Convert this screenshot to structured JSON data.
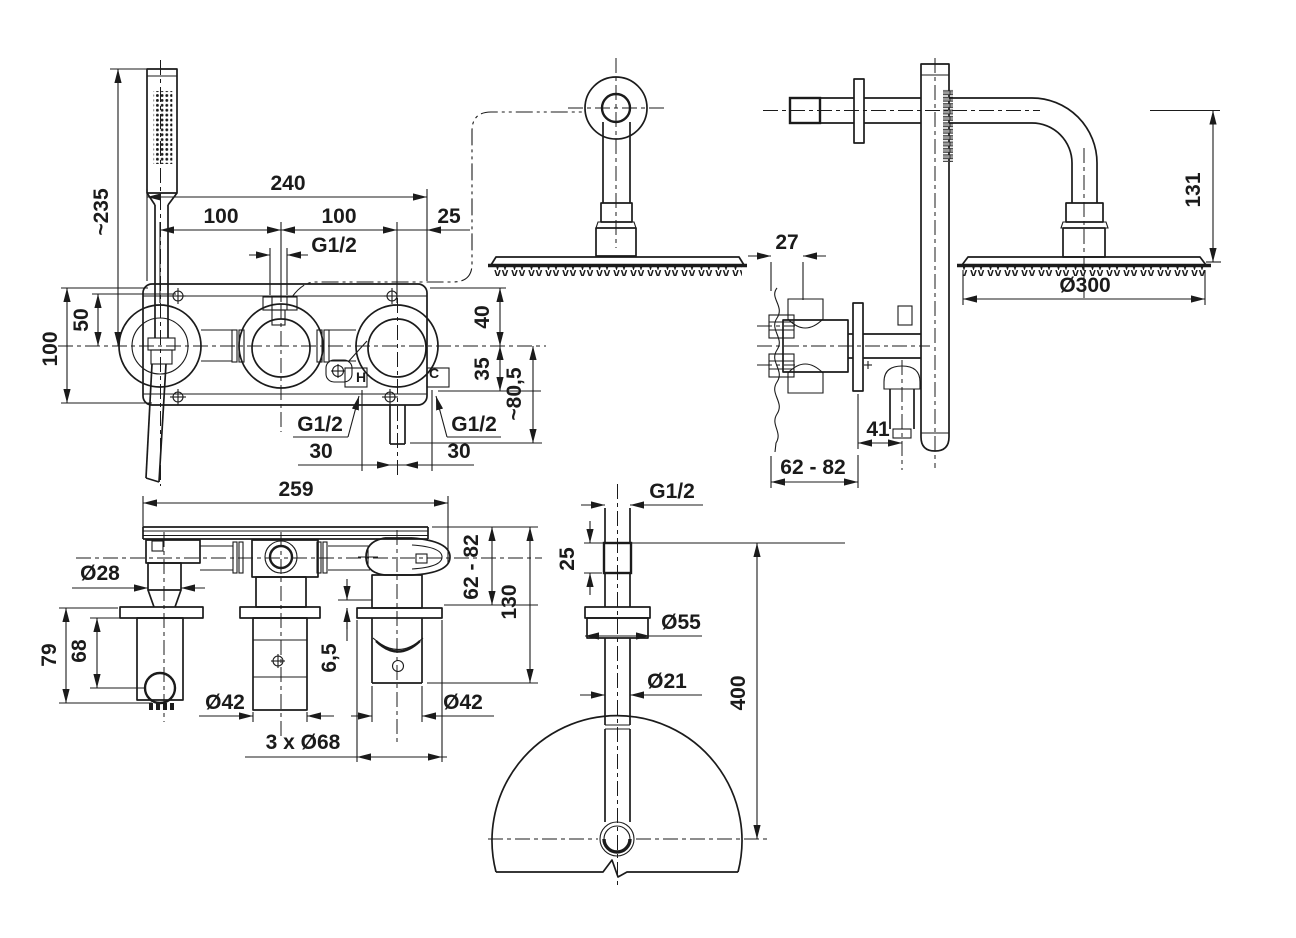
{
  "drawing": {
    "type": "technical-dimension-drawing",
    "subject": "concealed shower system with hand shower, bath mixer and overhead rain shower",
    "background_color": "#ffffff",
    "line_color": "#1b1b1b",
    "views": {
      "front": {
        "title": "front view - concealed mixer with hand shower",
        "labels": {
          "hand_shower_height": "~235",
          "overall_width": "240",
          "pitch_left": "100",
          "pitch_right": "100",
          "edge_offset": "25",
          "top_outlet_thread": "G1/2",
          "screw_offset": "50",
          "plate_height": "100",
          "outlet_drop_upper": "40",
          "outlet_drop_lower": "35",
          "spout_drop": "~80,5",
          "hot_thread": "G1/2",
          "cold_thread": "G1/2",
          "hot_offset": "30",
          "cold_offset": "30",
          "hot_marker": "H",
          "cold_marker": "C"
        }
      },
      "side": {
        "title": "side view - wall section with shower arm",
        "labels": {
          "supply_embed_depth": "27",
          "arm_drop": "131",
          "head_diameter": "Ø300",
          "spout_projection": "41",
          "wall_depth_range": "62 - 82"
        }
      },
      "plan": {
        "title": "plan view - concealed body",
        "labels": {
          "body_width": "259",
          "holder_diameter": "Ø28",
          "holder_total_drop": "79",
          "holder_drop": "68",
          "valve_diameter": "Ø42",
          "spout_offset": "6,5",
          "spout_diameter": "Ø42",
          "escutcheons": "3 x Ø68",
          "wall_depth_range": "62 - 82",
          "spout_total_drop": "130"
        }
      },
      "ceiling": {
        "title": "ceiling shower arm with head",
        "labels": {
          "thread": "G1/2",
          "thread_length": "25",
          "flange_diameter": "Ø55",
          "pipe_diameter": "Ø21",
          "arm_length": "400"
        }
      }
    }
  }
}
